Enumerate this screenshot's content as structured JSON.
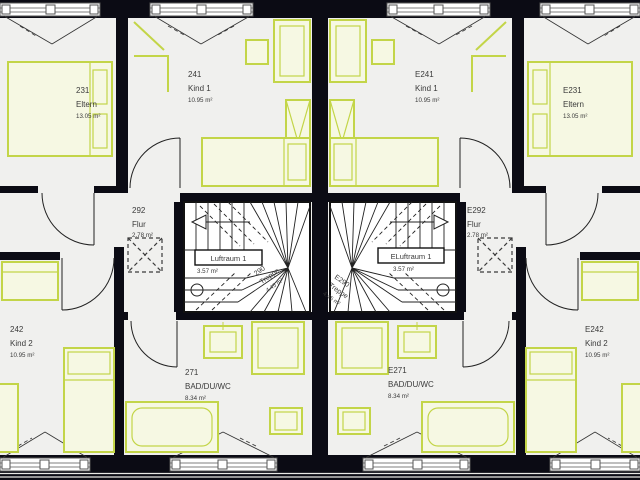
{
  "plan": {
    "type": "duplex-floor-plan",
    "colors": {
      "furniture_accent": "#c3d548",
      "wall": "#0b0b14",
      "floor": "#f0f0ee"
    },
    "rooms": {
      "r231": {
        "id": "231",
        "name": "Eltern",
        "area": "13.05 m²"
      },
      "r241": {
        "id": "241",
        "name": "Kind 1",
        "area": "10.95 m²"
      },
      "r242": {
        "id": "242",
        "name": "Kind 2",
        "area": "10.95 m²"
      },
      "r271": {
        "id": "271",
        "name": "BAD/DU/WC",
        "area": "8.34 m²"
      },
      "r292": {
        "id": "292",
        "name": "Flur",
        "area": "2.78 m²"
      },
      "r290": {
        "id": "290",
        "name": "Treppe",
        "area": "4.45 m²"
      },
      "luft": {
        "name": "Luftraum 1",
        "area": "3.57 m²"
      },
      "e231": {
        "id": "E231",
        "name": "Eltern",
        "area": "13.05 m²"
      },
      "e241": {
        "id": "E241",
        "name": "Kind 1",
        "area": "10.95 m²"
      },
      "e242": {
        "id": "E242",
        "name": "Kind 2",
        "area": "10.95 m²"
      },
      "e271": {
        "id": "E271",
        "name": "BAD/DU/WC",
        "area": "8.34 m²"
      },
      "e292": {
        "id": "E292",
        "name": "Flur",
        "area": "2.78 m²"
      },
      "e290": {
        "id": "E290",
        "name": "Treppe",
        "area": "4.45 m²"
      },
      "eluft": {
        "name": "ELuftraum 1",
        "area": "3.57 m²"
      }
    }
  }
}
